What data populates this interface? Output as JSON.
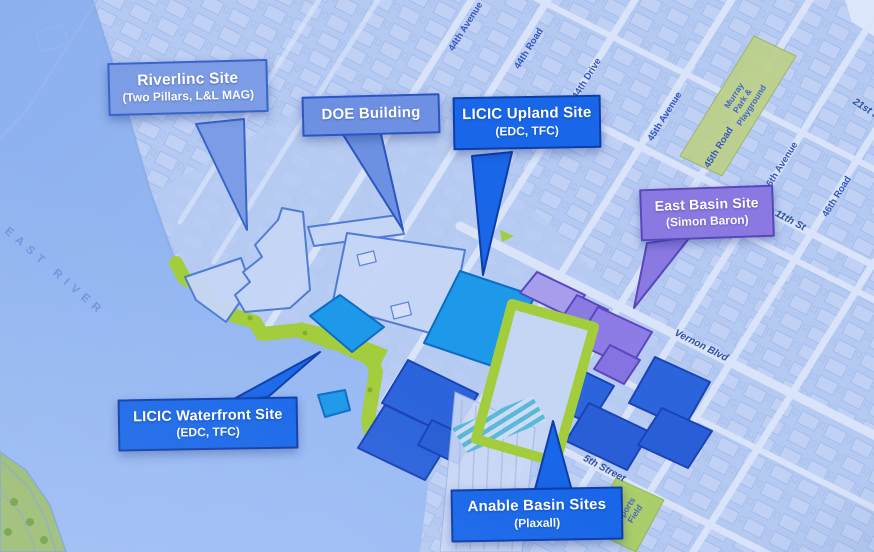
{
  "photo": {
    "description": "Projected isometric map of Long Island City waterfront development sites",
    "water_label": "EAST RIVER",
    "streets": [
      {
        "id": "44th-avenue",
        "label": "44th Avenue"
      },
      {
        "id": "44th-road",
        "label": "44th Road"
      },
      {
        "id": "44th-drive",
        "label": "44th Drive"
      },
      {
        "id": "45th-avenue",
        "label": "45th Avenue"
      },
      {
        "id": "45th-road",
        "label": "45th Road"
      },
      {
        "id": "46th-avenue",
        "label": "46th Avenue"
      },
      {
        "id": "46th-road",
        "label": "46th Road"
      },
      {
        "id": "21st-st",
        "label": "21st St"
      },
      {
        "id": "11th-st",
        "label": "11th St"
      },
      {
        "id": "vernon-blvd",
        "label": "Vernon Blvd"
      },
      {
        "id": "5th-street",
        "label": "5th Street"
      }
    ],
    "parks": {
      "murray": {
        "lines": [
          "Murray",
          "Park &",
          "Playground"
        ]
      },
      "sports": {
        "lines": [
          "Sports",
          "Field"
        ]
      }
    },
    "callouts": [
      {
        "id": "riverlinc",
        "title": "Riverlinc Site",
        "subtitle": "(Two Pillars, L&L MAG)",
        "fill": "#7d9ce4",
        "border": "#3a64c8"
      },
      {
        "id": "doe-building",
        "title": "DOE Building",
        "subtitle": "",
        "fill": "#6e90e0",
        "border": "#2c55c0"
      },
      {
        "id": "licic-upland",
        "title": "LICIC Upland Site",
        "subtitle": "(EDC, TFC)",
        "fill": "#1b67e4",
        "border": "#0d3da6"
      },
      {
        "id": "east-basin",
        "title": "East Basin Site",
        "subtitle": "(Simon Baron)",
        "fill": "#8a79de",
        "border": "#5a46b8"
      },
      {
        "id": "licic-waterfront",
        "title": "LICIC Waterfront Site",
        "subtitle": "(EDC, TFC)",
        "fill": "#1b67e4",
        "border": "#0d3da6"
      },
      {
        "id": "anable-basin",
        "title": "Anable Basin Sites",
        "subtitle": "(Plaxall)",
        "fill": "#1b67e4",
        "border": "#0d3da6"
      }
    ],
    "map_colors": {
      "land": "#b6caf1",
      "water": "#8fb2ec",
      "street": "#dbe5fa",
      "greenway": "#a4cc40",
      "park_green": "#bcd08a",
      "pale_parcel": "#c6d6f6",
      "cyan_parcel": "#2197e6",
      "blue_parcel": "#2e64d8",
      "purple_parcel": "#8d7ce2",
      "street_label": "#3556bd"
    }
  }
}
